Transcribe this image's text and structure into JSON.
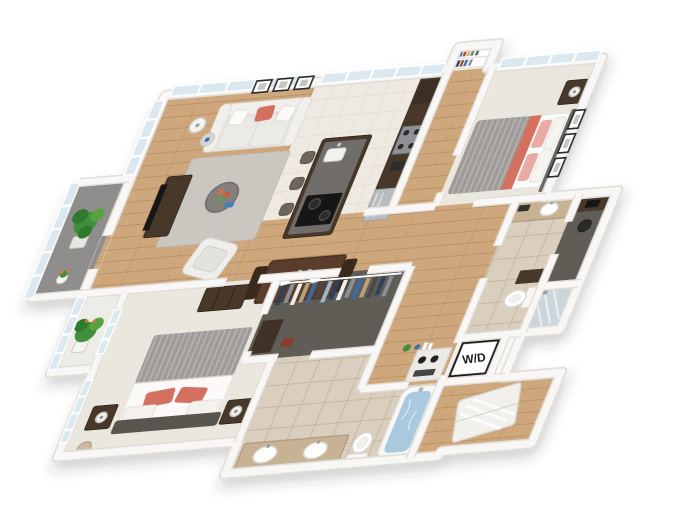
{
  "scene": {
    "type": "3d-floorplan-rendering",
    "alt": "Isometric 3D rendered floor plan of a two-bedroom two-bath apartment"
  },
  "labels": {
    "washer_dryer": "W/D"
  },
  "rooms": [
    "living-room",
    "dining-area",
    "kitchen",
    "entry",
    "bedroom-2",
    "hallway",
    "bathroom-2",
    "office-nook",
    "shower-room",
    "wd-closet",
    "storage-room",
    "walk-in-closet",
    "master-bathroom",
    "master-bedroom",
    "window-bay",
    "balcony"
  ],
  "colors": {
    "background": "#ffffff",
    "wall": "#f8f7f5",
    "wall_edge": "#e0ddd8",
    "wood": "#cfa77c",
    "tile_kitchen": "#efeae1",
    "tile_bath": "#dacfbe",
    "carpet": "#eae7df",
    "closet_floor": "#615c56",
    "balcony_floor": "#8f8e8c",
    "cabinet": "#46372b",
    "island_top": "#6f6d6a",
    "sofa": "#e9e8e4",
    "coral": "#d4705f",
    "pink": "#e8aba5",
    "rug": "#cac7c1",
    "plant": "#3f8f3d",
    "plant_dark": "#2f7a2e",
    "plant_light": "#57a33f",
    "water": "#a9cade",
    "glass": "#dce8f0",
    "appliance": "#b9bcbe",
    "vanity": "#c7b294",
    "blanket": "#9e9b99",
    "dark_item": "#1f1f1f"
  }
}
